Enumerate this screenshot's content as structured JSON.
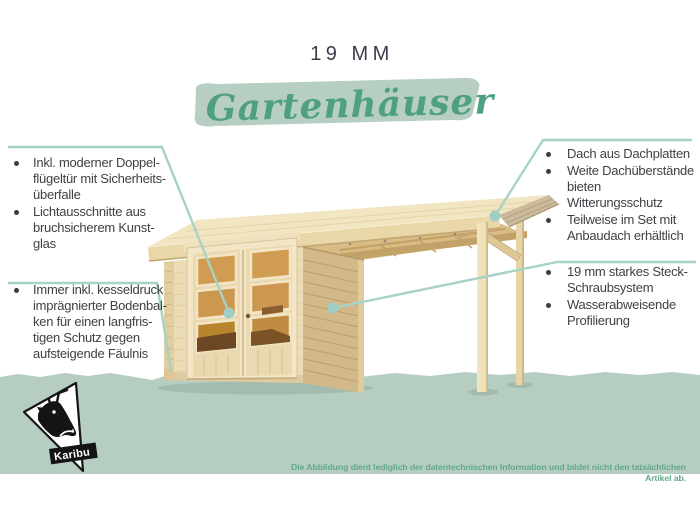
{
  "header": {
    "category_label": "19 MM",
    "title_script": "Gartenhäuser"
  },
  "features_left_top": [
    "Inkl. moderner Doppel-\nflügeltür mit Sicherheits-\nüberfalle",
    "Lichtausschnitte aus\nbruchsicherem Kunst-\nglas"
  ],
  "features_left_bottom": [
    "Immer inkl. kesseldruck\nimprägnierter Bodenbal-\nken für einen langfris-\ntigen Schutz gegen\naufsteigende Fäulnis"
  ],
  "features_right_top": [
    "Dach aus Dachplatten",
    "Weite Dachüberstände\nbieten Witterungsschutz",
    "Teilweise im Set mit\nAnbaudach erhältlich"
  ],
  "features_right_bottom": [
    "19 mm starkes Steck-\nSchraubsystem",
    "Wasserabweisende\nProfilierung"
  ],
  "footer": {
    "brand": "Karibu",
    "disclaimer": "Die Abbildung dient lediglich der datentechnischen Information und bildet nicht den tatsächlichen Artikel ab."
  },
  "colors": {
    "accent_teal_line": "#a6d2c7",
    "sage_band": "#b6cec1",
    "brush_stroke": "#b6cfc2",
    "script_green": "#4f9f83",
    "disclaimer_green": "#63a88c",
    "heading_dark": "#3b3e4b",
    "body_text": "#3e4145",
    "wood_roof": "#f1e5c2",
    "wood_front_wall": "#ecdcb5",
    "wood_side_wall": "#d3b98a",
    "door_glass_orange": "#d09c51"
  }
}
